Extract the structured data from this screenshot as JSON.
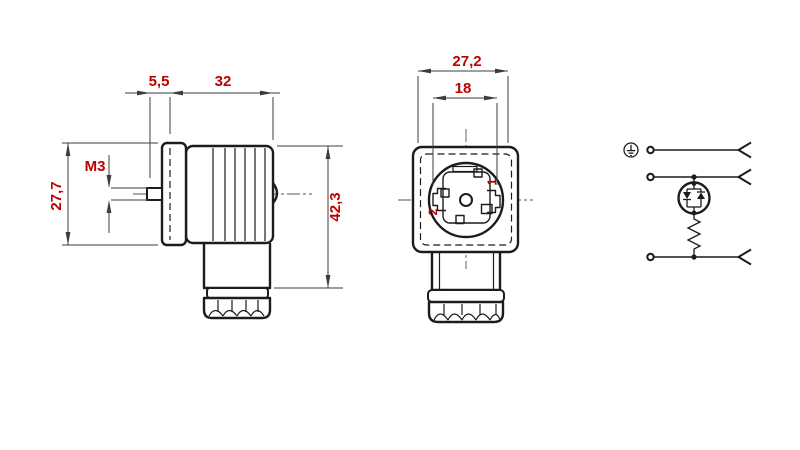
{
  "page": {
    "background": "#ffffff"
  },
  "colors": {
    "line": "#1c1c1c",
    "dim_line": "#3c3c3c",
    "accent_red": "#bf0000",
    "centerline": "#555555"
  },
  "side_view": {
    "title": "connector side view",
    "dim_pin_offset": "5,5",
    "dim_body_length": "32",
    "dim_flange_height": "27,7",
    "dim_thread": "M3",
    "dim_total_height": "42,3"
  },
  "front_view": {
    "title": "connector front view",
    "dim_width": "27,2",
    "dim_inner_diameter": "18",
    "pin1_label": "1",
    "pin2_label": "2"
  },
  "schematic": {
    "title": "wiring diagram",
    "icons": {
      "earth": "protective-earth-icon",
      "terminal": "terminal-circle-icon",
      "led": "bidirectional-led-icon",
      "resistor": "resistor-icon",
      "contact": "contact-chevron-icon"
    }
  }
}
